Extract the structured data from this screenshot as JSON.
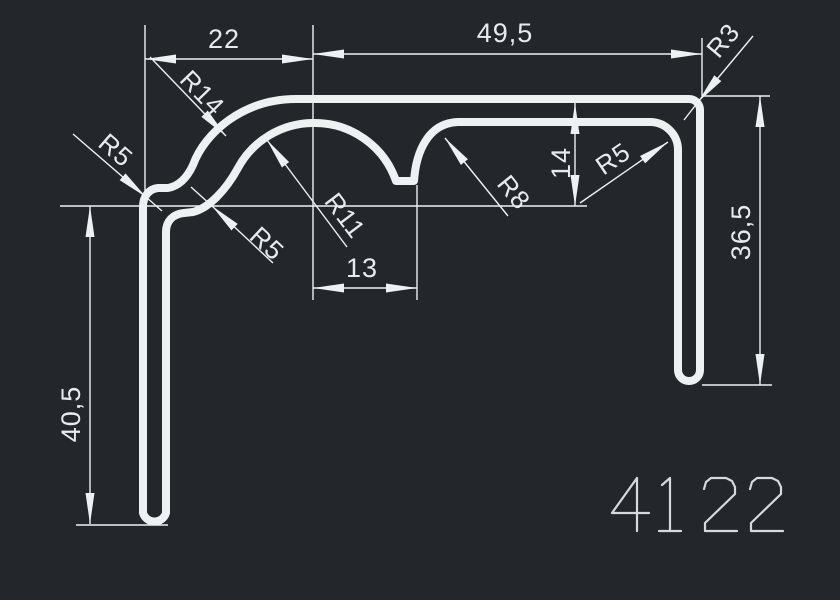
{
  "drawing": {
    "part_number": "4122",
    "dimension_labels": {
      "top_left_width": "22",
      "top_right_width": "49,5",
      "notch_width": "13",
      "flange_height": "14",
      "right_leg_height": "36,5",
      "left_leg_height": "40,5"
    },
    "radius_labels": {
      "r14": "R14",
      "r5_left": "R5",
      "r5_lower": "R5",
      "r11": "R11",
      "r8": "R8",
      "r5_right": "R5",
      "r3": "R3"
    }
  },
  "colors": {
    "canvas-bg": "#23272c",
    "line": "#eef1f3",
    "text": "#e8ebee",
    "part-number": "#d6dade"
  }
}
